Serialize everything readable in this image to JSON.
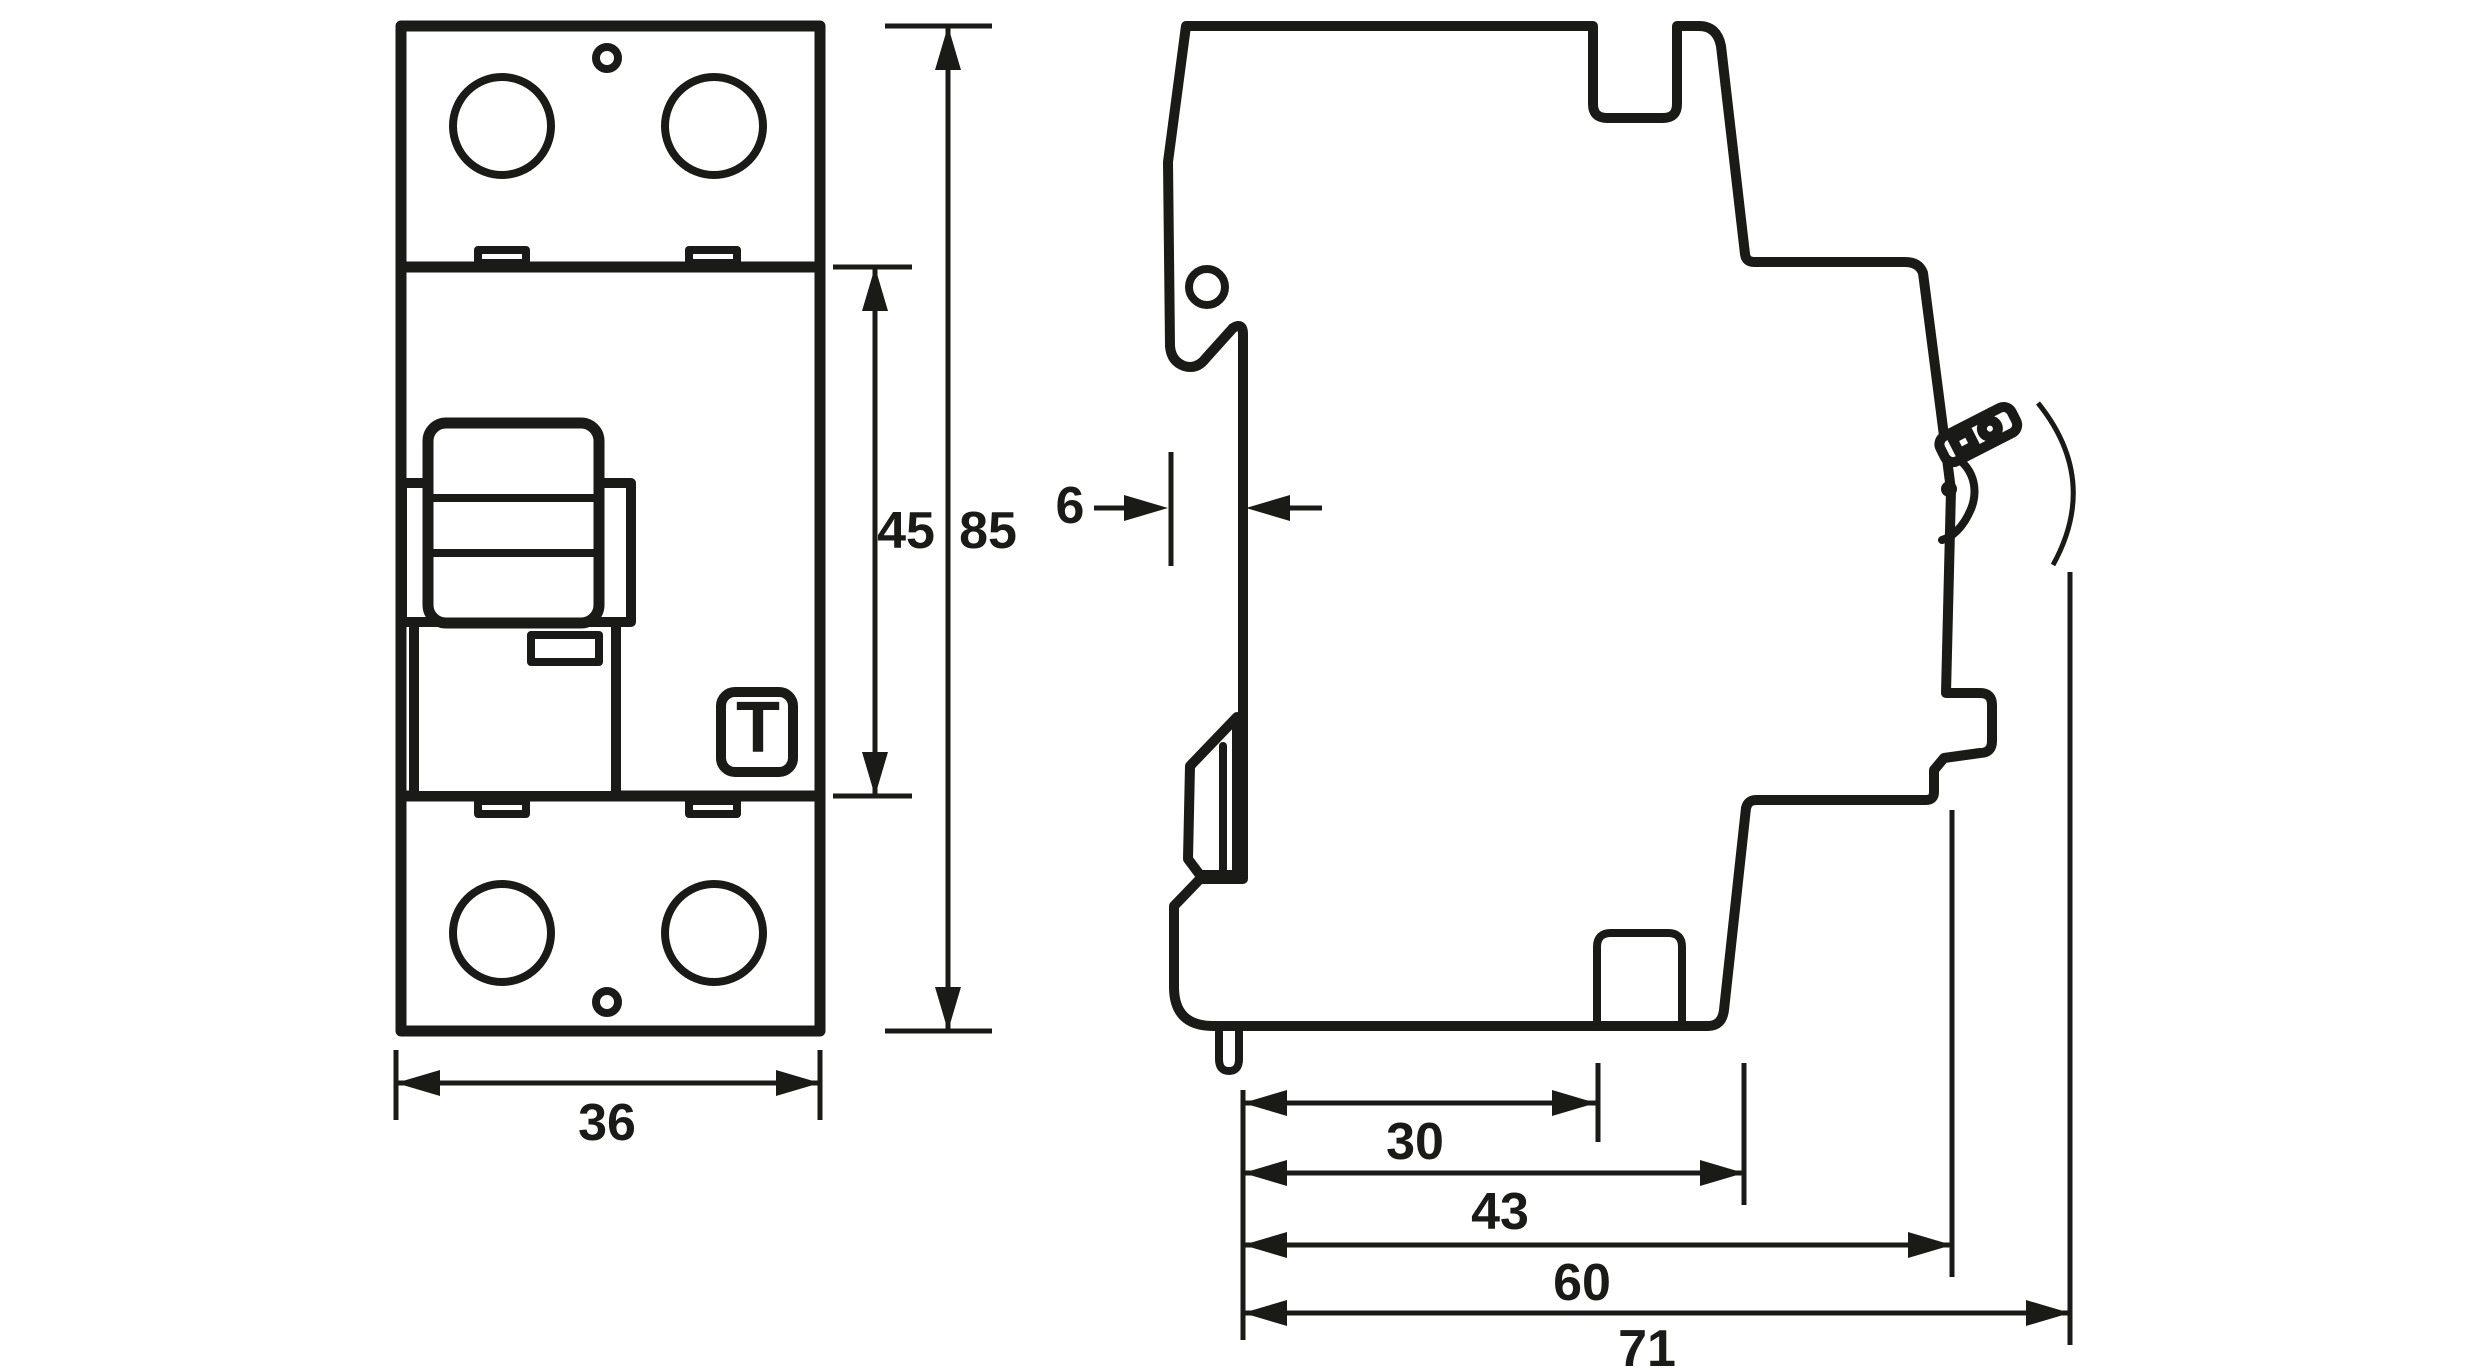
{
  "drawing": {
    "background": "#ffffff",
    "stroke_color": "#1a1a18",
    "front_view": {
      "test_button_label": "T",
      "width_mm": "36",
      "switch_section_height_mm": "45",
      "total_height_mm": "85"
    },
    "side_view": {
      "rail_step_depth_mm": "6",
      "depth_to_lower_terminal_mm": "30",
      "depth_to_terminal_body_mm": "43",
      "depth_to_front_face_mm": "60",
      "total_depth_mm": "71"
    }
  }
}
